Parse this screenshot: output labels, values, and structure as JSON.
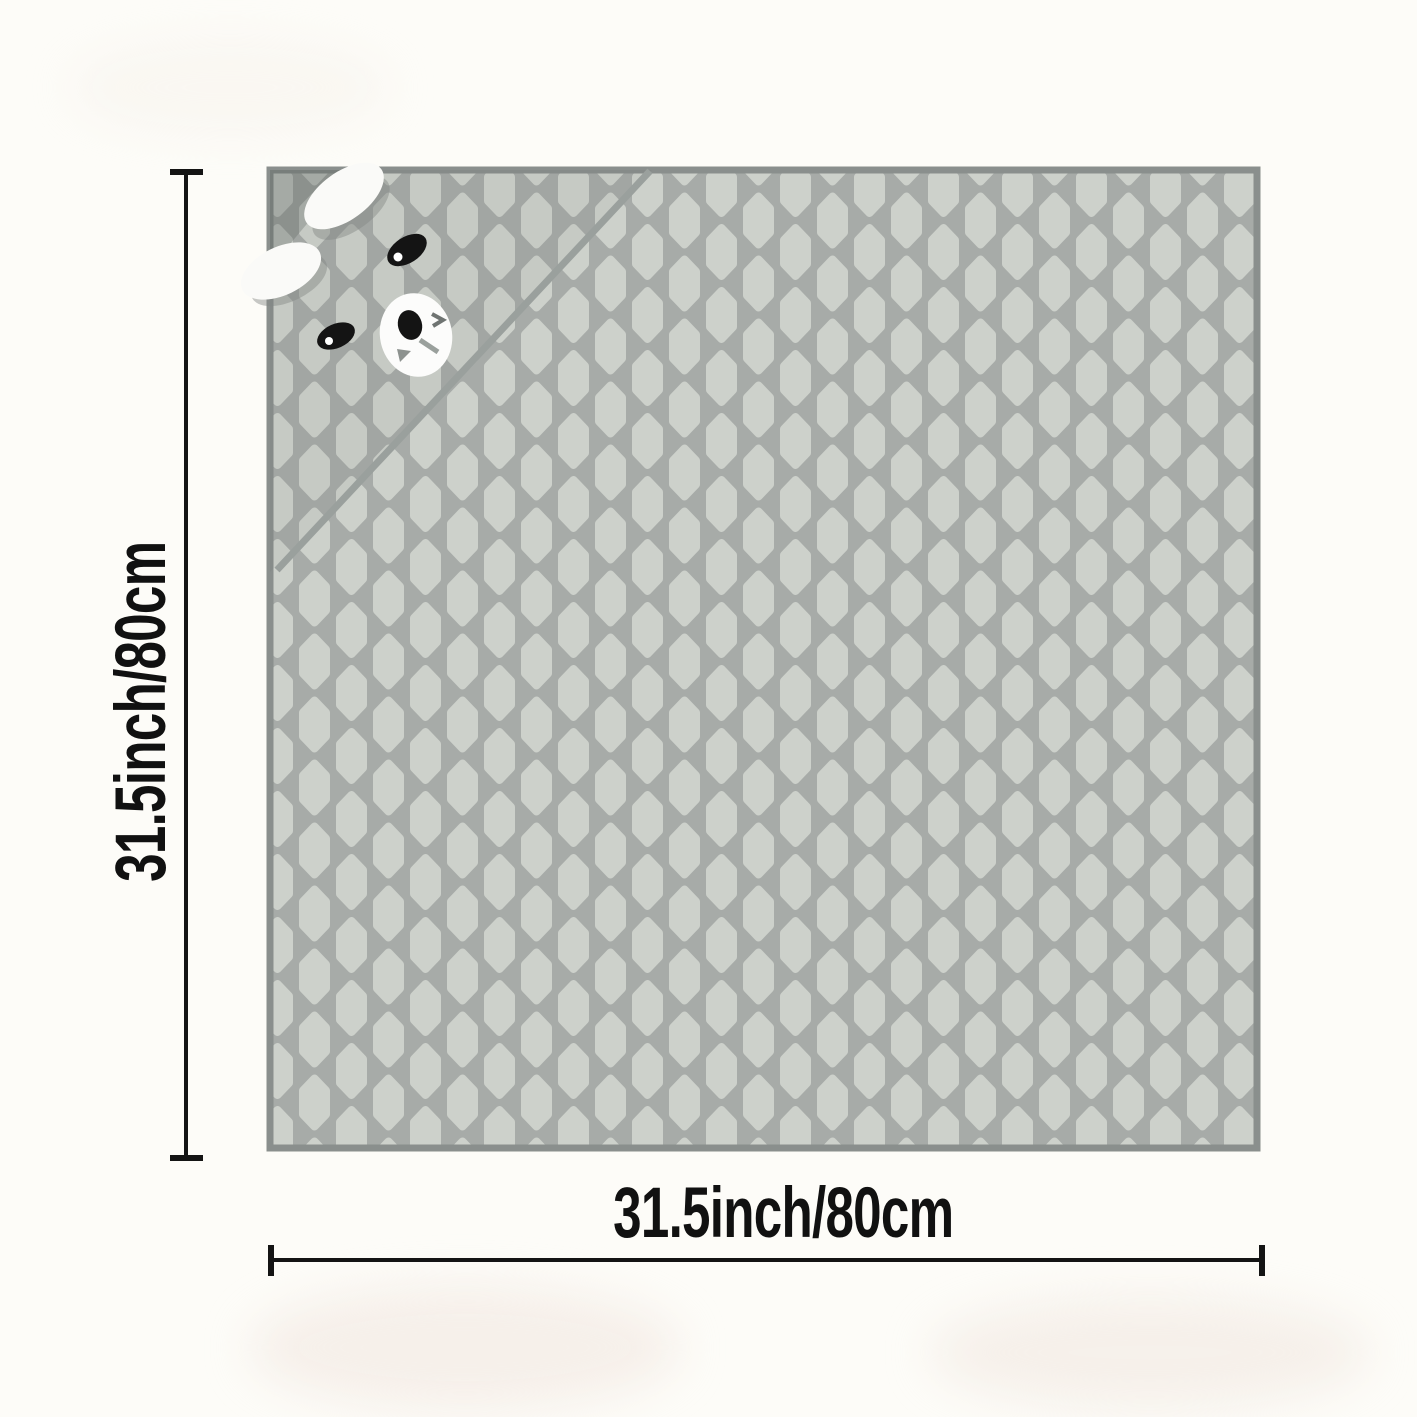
{
  "canvas": {
    "background": "#fdfcf8"
  },
  "product": {
    "pattern_fill": "#cdd1cb",
    "pattern_gap": "#a7aba8",
    "border_color": "#8a8f8d",
    "seam_color": "#9aa09d",
    "hood_shade": "rgba(90,95,93,0.30)",
    "ear_color": "#fafaf8",
    "eye_color": "#141414",
    "muzzle_color": "#fcfcfb",
    "mouth_mark_color": "#8d928f"
  },
  "dimensions": {
    "height_label": "31.5inch/80cm",
    "width_label": "31.5inch/80cm",
    "line_color": "#141414",
    "text_color": "#111111"
  }
}
